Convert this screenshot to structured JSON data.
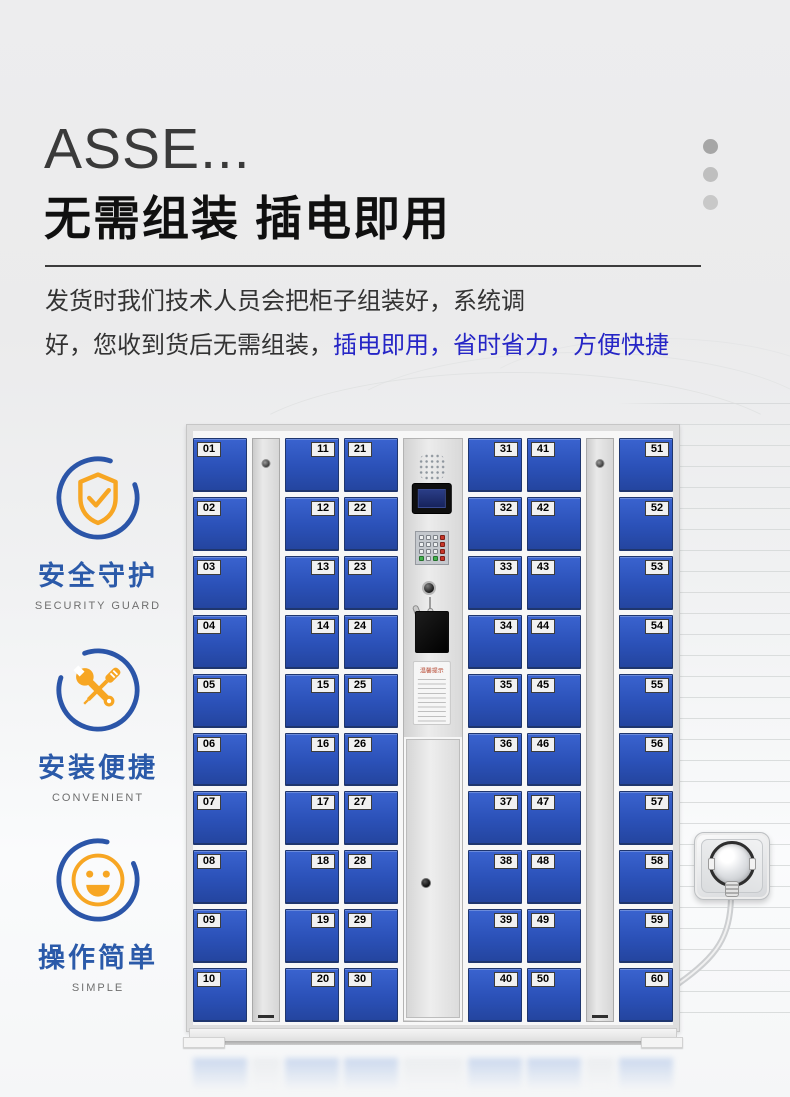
{
  "header": {
    "title_top": "ASSE...",
    "title_main": "无需组装  插电即用"
  },
  "description": {
    "line1": "发货时我们技术人员会把柜子组装好，系统调",
    "line2_dark": "好，您收到货后无需组装，",
    "line2_blue": "插电即用，省时省力，方便快捷"
  },
  "features": [
    {
      "icon": "shield-check-icon",
      "title": "安全守护",
      "subtitle": "SECURITY GUARD"
    },
    {
      "icon": "tools-icon",
      "title": "安装便捷",
      "subtitle": "CONVENIENT"
    },
    {
      "icon": "smiley-icon",
      "title": "操作简单",
      "subtitle": "SIMPLE"
    }
  ],
  "locker": {
    "tips_title": "温馨提示",
    "columns": [
      {
        "type": "doors",
        "label_side": "left",
        "numbers": [
          "01",
          "02",
          "03",
          "04",
          "05",
          "06",
          "07",
          "08",
          "09",
          "10"
        ]
      },
      {
        "type": "panel"
      },
      {
        "type": "doors",
        "label_side": "right",
        "numbers": [
          "11",
          "12",
          "13",
          "14",
          "15",
          "16",
          "17",
          "18",
          "19",
          "20"
        ]
      },
      {
        "type": "doors",
        "label_side": "left",
        "numbers": [
          "21",
          "22",
          "23",
          "24",
          "25",
          "26",
          "27",
          "28",
          "29",
          "30"
        ]
      },
      {
        "type": "control"
      },
      {
        "type": "doors",
        "label_side": "right",
        "numbers": [
          "31",
          "32",
          "33",
          "34",
          "35",
          "36",
          "37",
          "38",
          "39",
          "40"
        ]
      },
      {
        "type": "doors",
        "label_side": "left",
        "numbers": [
          "41",
          "42",
          "43",
          "44",
          "45",
          "46",
          "47",
          "48",
          "49",
          "50"
        ]
      },
      {
        "type": "panel"
      },
      {
        "type": "doors",
        "label_side": "right",
        "numbers": [
          "51",
          "52",
          "53",
          "54",
          "55",
          "56",
          "57",
          "58",
          "59",
          "60"
        ]
      }
    ]
  },
  "colors": {
    "door_blue": "#2b51b8",
    "accent_orange": "#f7a623",
    "feature_blue": "#2b5aa9",
    "highlight_text_blue": "#2626c6"
  }
}
